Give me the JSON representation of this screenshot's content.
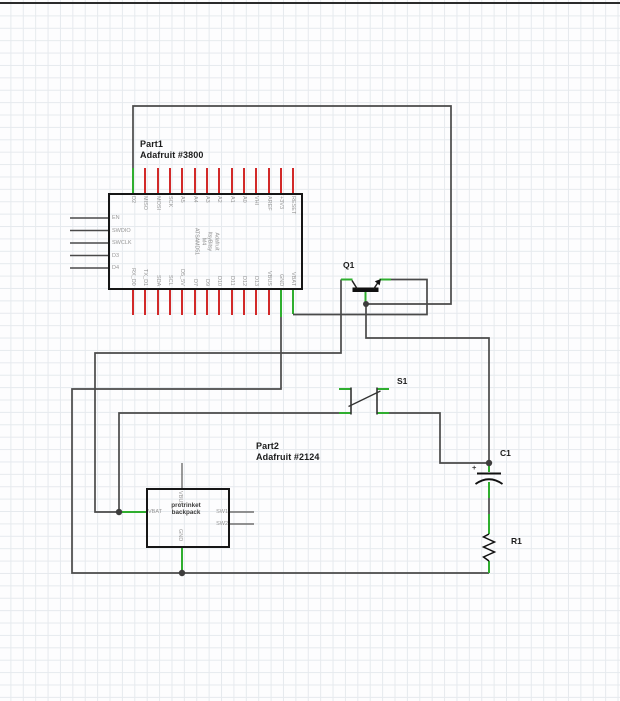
{
  "colors": {
    "wire": "#4a4a4a",
    "pin_connected_green": "#2fae2f",
    "pin_unconnected_red": "#d22929",
    "grid_line": "#e6eaee",
    "component_ink": "#161616",
    "pin_label_gray": "#979797"
  },
  "part1": {
    "designator": "Part1",
    "part_number": "Adafruit #3800",
    "center_label": [
      "Adafruit",
      "ItsyBitsy",
      "M4",
      "ATSAMD51"
    ],
    "top_pins": [
      "D2",
      "MISO",
      "MOSI",
      "SCK",
      "A5",
      "A4",
      "A3",
      "A2",
      "A1",
      "A0",
      "VHI",
      "AREF",
      "+3V3",
      "RESET"
    ],
    "bottom_pins": [
      "RX_D0",
      "TX_D1",
      "SDA",
      "SCL",
      "D5_5V",
      "D7",
      "D9",
      "D10",
      "D11",
      "D12",
      "D13",
      "VBUS",
      "GND",
      "VBAT"
    ],
    "left_pins": [
      "EN",
      "SWDIO",
      "SWCLK",
      "D3",
      "D4"
    ]
  },
  "part2": {
    "designator": "Part2",
    "part_number": "Adafruit #2124",
    "center_label_line1": "protrinket",
    "center_label_line2": "backpack",
    "pin_top": "VBUS",
    "pin_left": "VBAT",
    "pin_right1": "SW1",
    "pin_right2": "SW2",
    "pin_bottom": "GND"
  },
  "components": {
    "transistor": "Q1",
    "switch": "S1",
    "capacitor": "C1",
    "capacitor_polarity": "+",
    "resistor": "R1"
  }
}
